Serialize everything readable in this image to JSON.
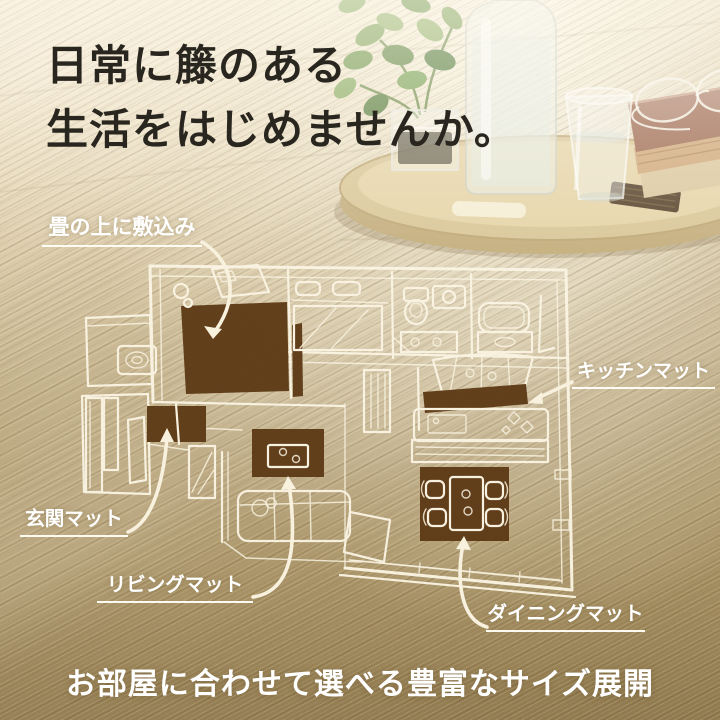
{
  "headline": {
    "line1": "日常に籐のある",
    "line2": "生活をはじめませんか。"
  },
  "callouts": {
    "tatami": {
      "label": "畳の上に敷込み"
    },
    "kitchen": {
      "label": "キッチンマット"
    },
    "entrance": {
      "label": "玄関マット"
    },
    "living": {
      "label": "リビングマット"
    },
    "dining": {
      "label": "ダイニングマット"
    }
  },
  "tagline": "お部屋に合わせて選べる豊富なサイズ展開",
  "floorplan": {
    "mats": [
      "tatami",
      "entrance",
      "living",
      "kitchen",
      "dining"
    ]
  },
  "scene_props": [
    "potted-plant",
    "glass-vase",
    "water-bottle",
    "drinking-glass",
    "wooden-tray",
    "coaster",
    "books",
    "eyeglasses"
  ],
  "colors": {
    "mat_brown": "#5d3a16",
    "plan_line": "#faf4e3",
    "headline_text": "#29261f",
    "label_text": "#ffffff"
  }
}
